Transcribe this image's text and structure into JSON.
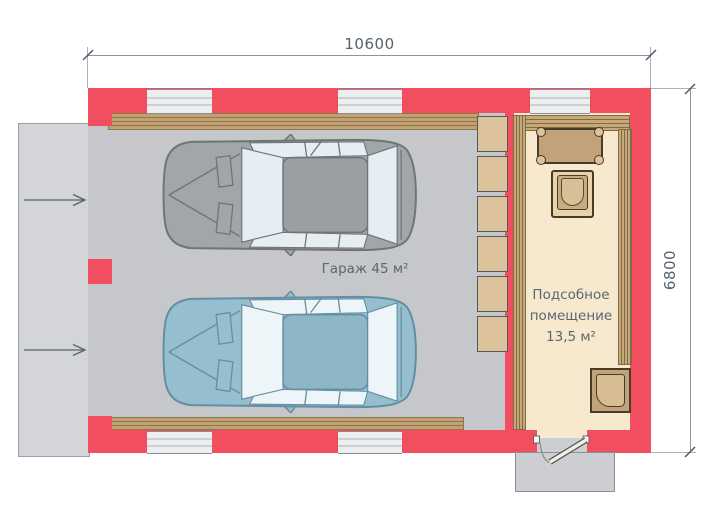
{
  "dimensions": {
    "top": "10600",
    "right": "6800"
  },
  "rooms": {
    "garage": {
      "label": "Гараж 45 м²"
    },
    "utility": {
      "label_lines": [
        "Подсобное",
        "помещение",
        "13,5 м²"
      ]
    }
  },
  "colors": {
    "wall_red": "#f14f5f",
    "garage_floor": "#c6c7ca",
    "driveway": "#d3d5d8",
    "porch": "#ccced1",
    "wood_trim": "#c4a173",
    "utility_floor": "#f7e9cd",
    "furniture_wood": "#c2a278",
    "shelf_wood": "#dcc29a",
    "window_glass": "#eceef0",
    "car_gray": "#a1a6a8",
    "car_blue": "#95bece",
    "dimension_text": "#55616d",
    "label_text": "#5b6673"
  }
}
